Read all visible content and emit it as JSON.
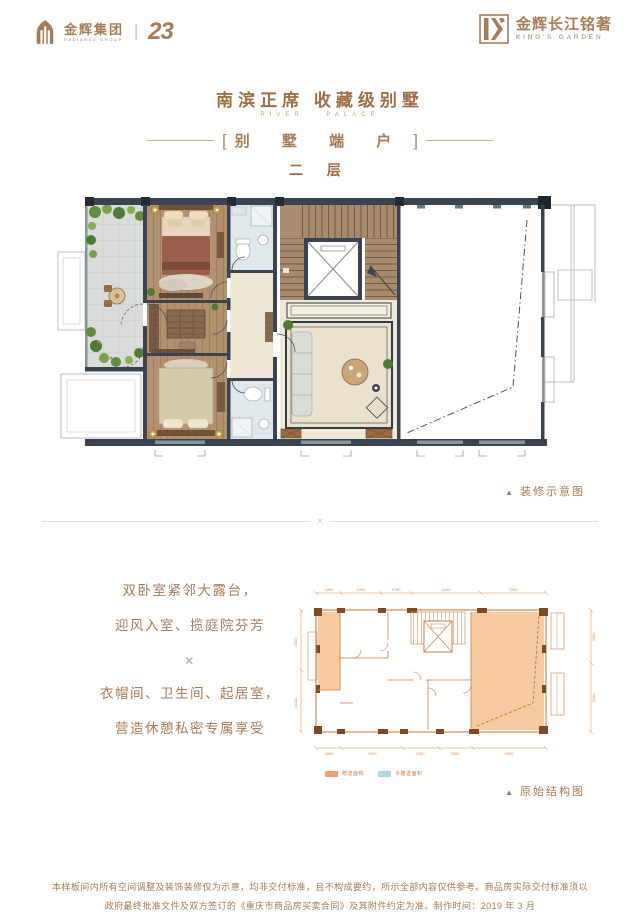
{
  "brand": {
    "group_cn": "金辉集团",
    "group_en": "RADIANCE GROUP",
    "anniversary": "23",
    "project_cn": "金辉长江铭著",
    "project_en": "KING'S GARDEN"
  },
  "header": {
    "title": "南滨正席 收藏级别墅",
    "subtitle": "RIVER PALACE",
    "bracket_left": "[",
    "bracket_right": "]",
    "unit_type": "别 墅 端 户",
    "floor": "二 层"
  },
  "captions": {
    "arrow": "▲",
    "decorated": "装修示意图",
    "original": "原始结构图"
  },
  "description": {
    "line1": "双卧室紧邻大露台，",
    "line2": "迎风入室、揽庭院芬芳",
    "ornament": "✕",
    "line3": "衣帽间、卫生间、起居室，",
    "line4": "营造休憩私密专属享受"
  },
  "divider_ornament": "✕",
  "legend": {
    "bonus_label": "赠送面积",
    "half_bonus_label": "半赠送面积",
    "bonus_color": "#f0a169",
    "half_bonus_color": "#aed9e4"
  },
  "dimensions": {
    "top": [
      "1800",
      "2400",
      "1750",
      "4400",
      "7200"
    ],
    "bottom": [
      "1800",
      "4400",
      "2450",
      "2050",
      "4900"
    ],
    "left": [
      "4300",
      "5100"
    ],
    "right": [
      "4600",
      "3300"
    ]
  },
  "footer": {
    "line1": "本样板间内所有空间调整及装饰装修仅为示意，均非交付标准，且不构成要约，所示全部内容仅供参考。商品房实际交付标准须以",
    "line2": "政府最终批准文件及双方签订的《重庆市商品房买卖合同》及其附件约定为准。制作时间：2019 年 3 月"
  }
}
